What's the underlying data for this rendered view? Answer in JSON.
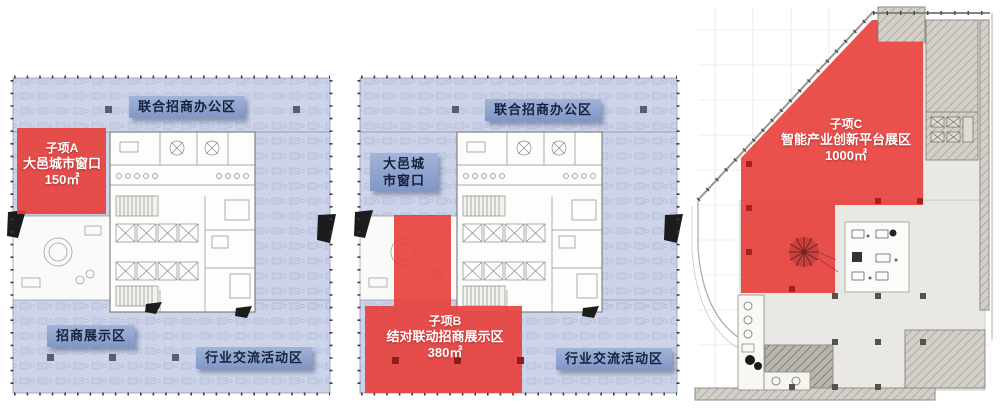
{
  "panels": [
    {
      "id": "floor-plan-a",
      "zone_labels": {
        "top": "联合招商办公区",
        "bottom_left": "招商展示区",
        "bottom_right": "行业交流活动区"
      },
      "highlight": {
        "name": "子项A",
        "desc": "大邑城市窗口",
        "area": "150㎡"
      }
    },
    {
      "id": "floor-plan-b",
      "zone_labels": {
        "top": "联合招商办公区",
        "left": "大邑城市窗口",
        "bottom_right": "行业交流活动区"
      },
      "highlight": {
        "name": "子项B",
        "desc": "结对联动招商展示区",
        "area": "380㎡"
      }
    },
    {
      "id": "floor-plan-c",
      "highlight": {
        "name": "子项C",
        "desc": "智能产业创新平台展区",
        "area": "1000㎡"
      }
    }
  ],
  "colors": {
    "highlight_red": "#E83E3A",
    "zone_fill_blue": "#CDD4EA",
    "label_bg_blue": "#8CA2CE",
    "label_text_navy": "#16213C"
  }
}
